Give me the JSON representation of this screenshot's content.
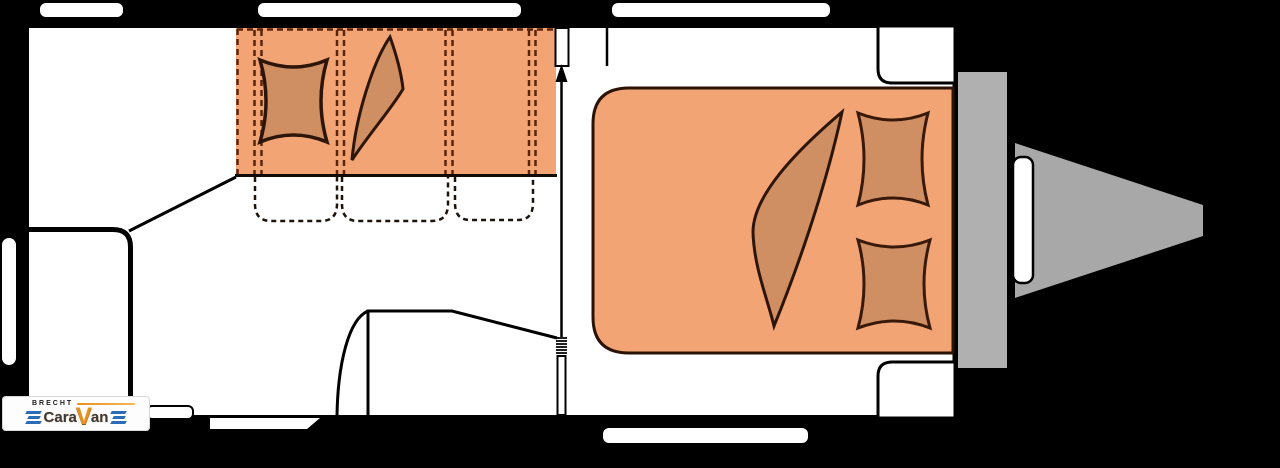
{
  "scene": {
    "description": "Caravan floor plan, top view, black background",
    "palette": {
      "background": "#000000",
      "body_fill": "#ffffff",
      "wall_color": "#000000",
      "cushion_orange": "#f2a474",
      "bedding_tan": "#d08f63",
      "furniture_outline": "#2e150a",
      "dash_brown": "#5a2408",
      "seat_dash_dark": "#1d130b",
      "metal_gray": "#b0b0b0",
      "drawbar_gray": "#a8a8a8"
    }
  },
  "logo": {
    "dealer": "BRECHT",
    "brand_part1": "Cara",
    "brand_part2": "V",
    "brand_part3": "an"
  }
}
